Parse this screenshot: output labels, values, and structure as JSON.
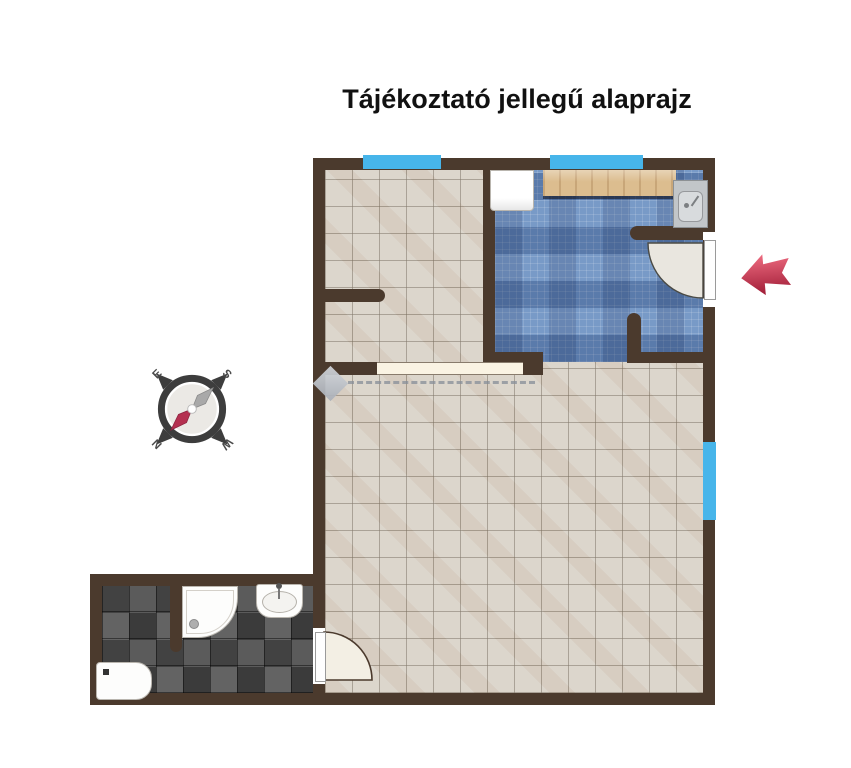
{
  "title": "Tájékoztató jellegű alaprajz",
  "compass": {
    "east": "E",
    "south": "S",
    "west": "W",
    "north": "N"
  },
  "colors": {
    "wall": "#4b3a2d",
    "window_glass": "#47b5ea",
    "entrance_arrow": "#c0274a",
    "floor_tile_beige": "#d8d1c6",
    "kitchen_tile_blue": "#6e92c3",
    "bathroom_tile_dark": "#4a4a4a",
    "counter_wood": "#dcbd8f",
    "compass_needle_red": "#b43050",
    "compass_needle_gray": "#a9a9a9"
  }
}
